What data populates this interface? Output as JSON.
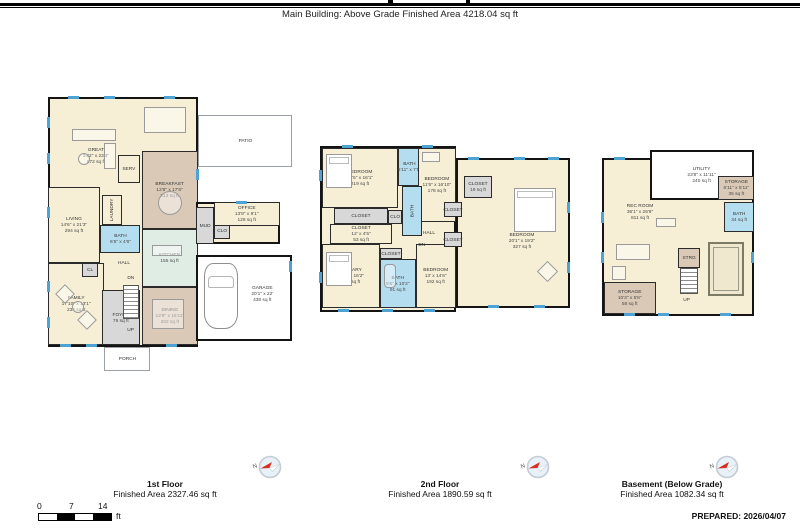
{
  "header": {
    "title": "Main Building: Above Grade Finished Area 4218.04 sq ft"
  },
  "palette": {
    "room_cream": "#f6efd5",
    "room_tan": "#dac9b6",
    "room_blue": "#b5ddf0",
    "room_teal": "#e0ede4",
    "room_gray": "#d8d8d8",
    "window_blue": "#4da3d4",
    "wall_black": "#141414",
    "compass_red": "#d83020"
  },
  "floors": [
    {
      "caption": "1st Floor",
      "caption_area": "Finished Area 2327.46 sq ft",
      "compass": "N",
      "rooms": [
        {
          "name": "GREAT",
          "dims": "34'2\" x 23'3\"",
          "area": "672 sq ft"
        },
        {
          "name": "PATIO"
        },
        {
          "name": "SERV"
        },
        {
          "name": "BREAKFAST",
          "dims": "12'8\" x 17'6\"",
          "area": "213 sq ft"
        },
        {
          "name": "KITCHEN",
          "area": "155 sq ft"
        },
        {
          "name": "LIVING",
          "dims": "14'6\" x 21'3\"",
          "area": "294 sq ft"
        },
        {
          "name": "LAUNDRY"
        },
        {
          "name": "BATH",
          "dims": "6'5\" x 4'6\""
        },
        {
          "name": "MUD"
        },
        {
          "name": "CLO"
        },
        {
          "name": "OFFICE",
          "dims": "13'8\" x 9'1\"",
          "area": "128 sq ft"
        },
        {
          "name": "HALL"
        },
        {
          "name": "CL"
        },
        {
          "name": "FAMILY",
          "dims": "17'10\" x 13'1\"",
          "area": "234 sq ft"
        },
        {
          "name": "DN"
        },
        {
          "name": "FOYER",
          "area": "76 sq ft"
        },
        {
          "name": "UP"
        },
        {
          "name": "DINING",
          "dims": "12'8\" x 15'11\"",
          "area": "202 sq ft"
        },
        {
          "name": "GARAGE",
          "dims": "20'1\" x 22'",
          "area": "438 sq ft"
        },
        {
          "name": "PORCH"
        }
      ]
    },
    {
      "caption": "2nd Floor",
      "caption_area": "Finished Area 1890.59 sq ft",
      "compass": "N",
      "rooms": [
        {
          "name": "BEDROOM",
          "dims": "13'5\" x 16'1\"",
          "area": "219 sq ft"
        },
        {
          "name": "BATH",
          "dims": "6'11\" x 7'5\""
        },
        {
          "name": "BEDROOM",
          "dims": "11'5\" x 16'10\"",
          "area": "178 sq ft"
        },
        {
          "name": "CLOSET"
        },
        {
          "name": "CLOSET",
          "dims": "12' x 4'5\"",
          "area": "53 sq ft"
        },
        {
          "name": "BATH"
        },
        {
          "name": "CLO"
        },
        {
          "name": "HALL"
        },
        {
          "name": "DN"
        },
        {
          "name": "PRIMARY",
          "dims": "12'5\" x 16'2\"",
          "area": "223 sq ft"
        },
        {
          "name": "CLOSET"
        },
        {
          "name": "BATH",
          "dims": "9'6\" x 10'2\"",
          "area": "91 sq ft"
        },
        {
          "name": "BEDROOM",
          "dims": "13' x 14'6\"",
          "area": "192 sq ft"
        },
        {
          "name": "CLOSET",
          "area": "19 sq ft"
        },
        {
          "name": "BEDROOM",
          "dims": "20'1\" x 19'2\"",
          "area": "327 sq ft"
        },
        {
          "name": "CLOSET"
        },
        {
          "name": "CLOSET"
        }
      ]
    },
    {
      "caption": "Basement (Below Grade)",
      "caption_area": "Finished Area 1082.34 sq ft",
      "compass": "N",
      "rooms": [
        {
          "name": "REC ROOM",
          "dims": "36'1\" x 26'6\"",
          "area": "811 sq ft"
        },
        {
          "name": "UTILITY",
          "dims": "23'8\" x 11'11\"",
          "area": "240 sq ft"
        },
        {
          "name": "STORAGE",
          "dims": "6'11\" x 5'11\"",
          "area": "35 sq ft"
        },
        {
          "name": "BATH",
          "area": "34 sq ft"
        },
        {
          "name": "STRG"
        },
        {
          "name": "UP"
        },
        {
          "name": "STORAGE",
          "dims": "10'3\" x 5'8\"",
          "area": "58 sq ft"
        }
      ]
    }
  ],
  "scale_bar": {
    "ticks": [
      "0",
      "7",
      "14"
    ],
    "unit": "ft"
  },
  "footer": {
    "prepared": "PREPARED: 2026/04/07"
  }
}
